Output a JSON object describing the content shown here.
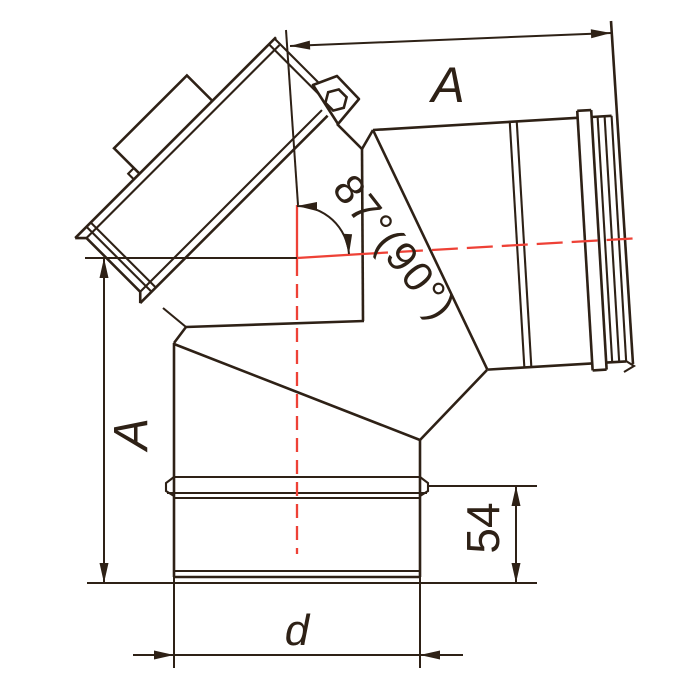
{
  "figure": {
    "type": "technical-drawing",
    "subject": "87-degree (90) elbow flue fitting with inspection branch, side view",
    "labels": {
      "top_width": "A",
      "left_height": "A",
      "socket_depth": "54",
      "diameter": "d",
      "angle": "87°(90°)"
    },
    "colors": {
      "ink": "#2e2116",
      "centerline_red": "#ee4136",
      "background": "#ffffff"
    }
  }
}
